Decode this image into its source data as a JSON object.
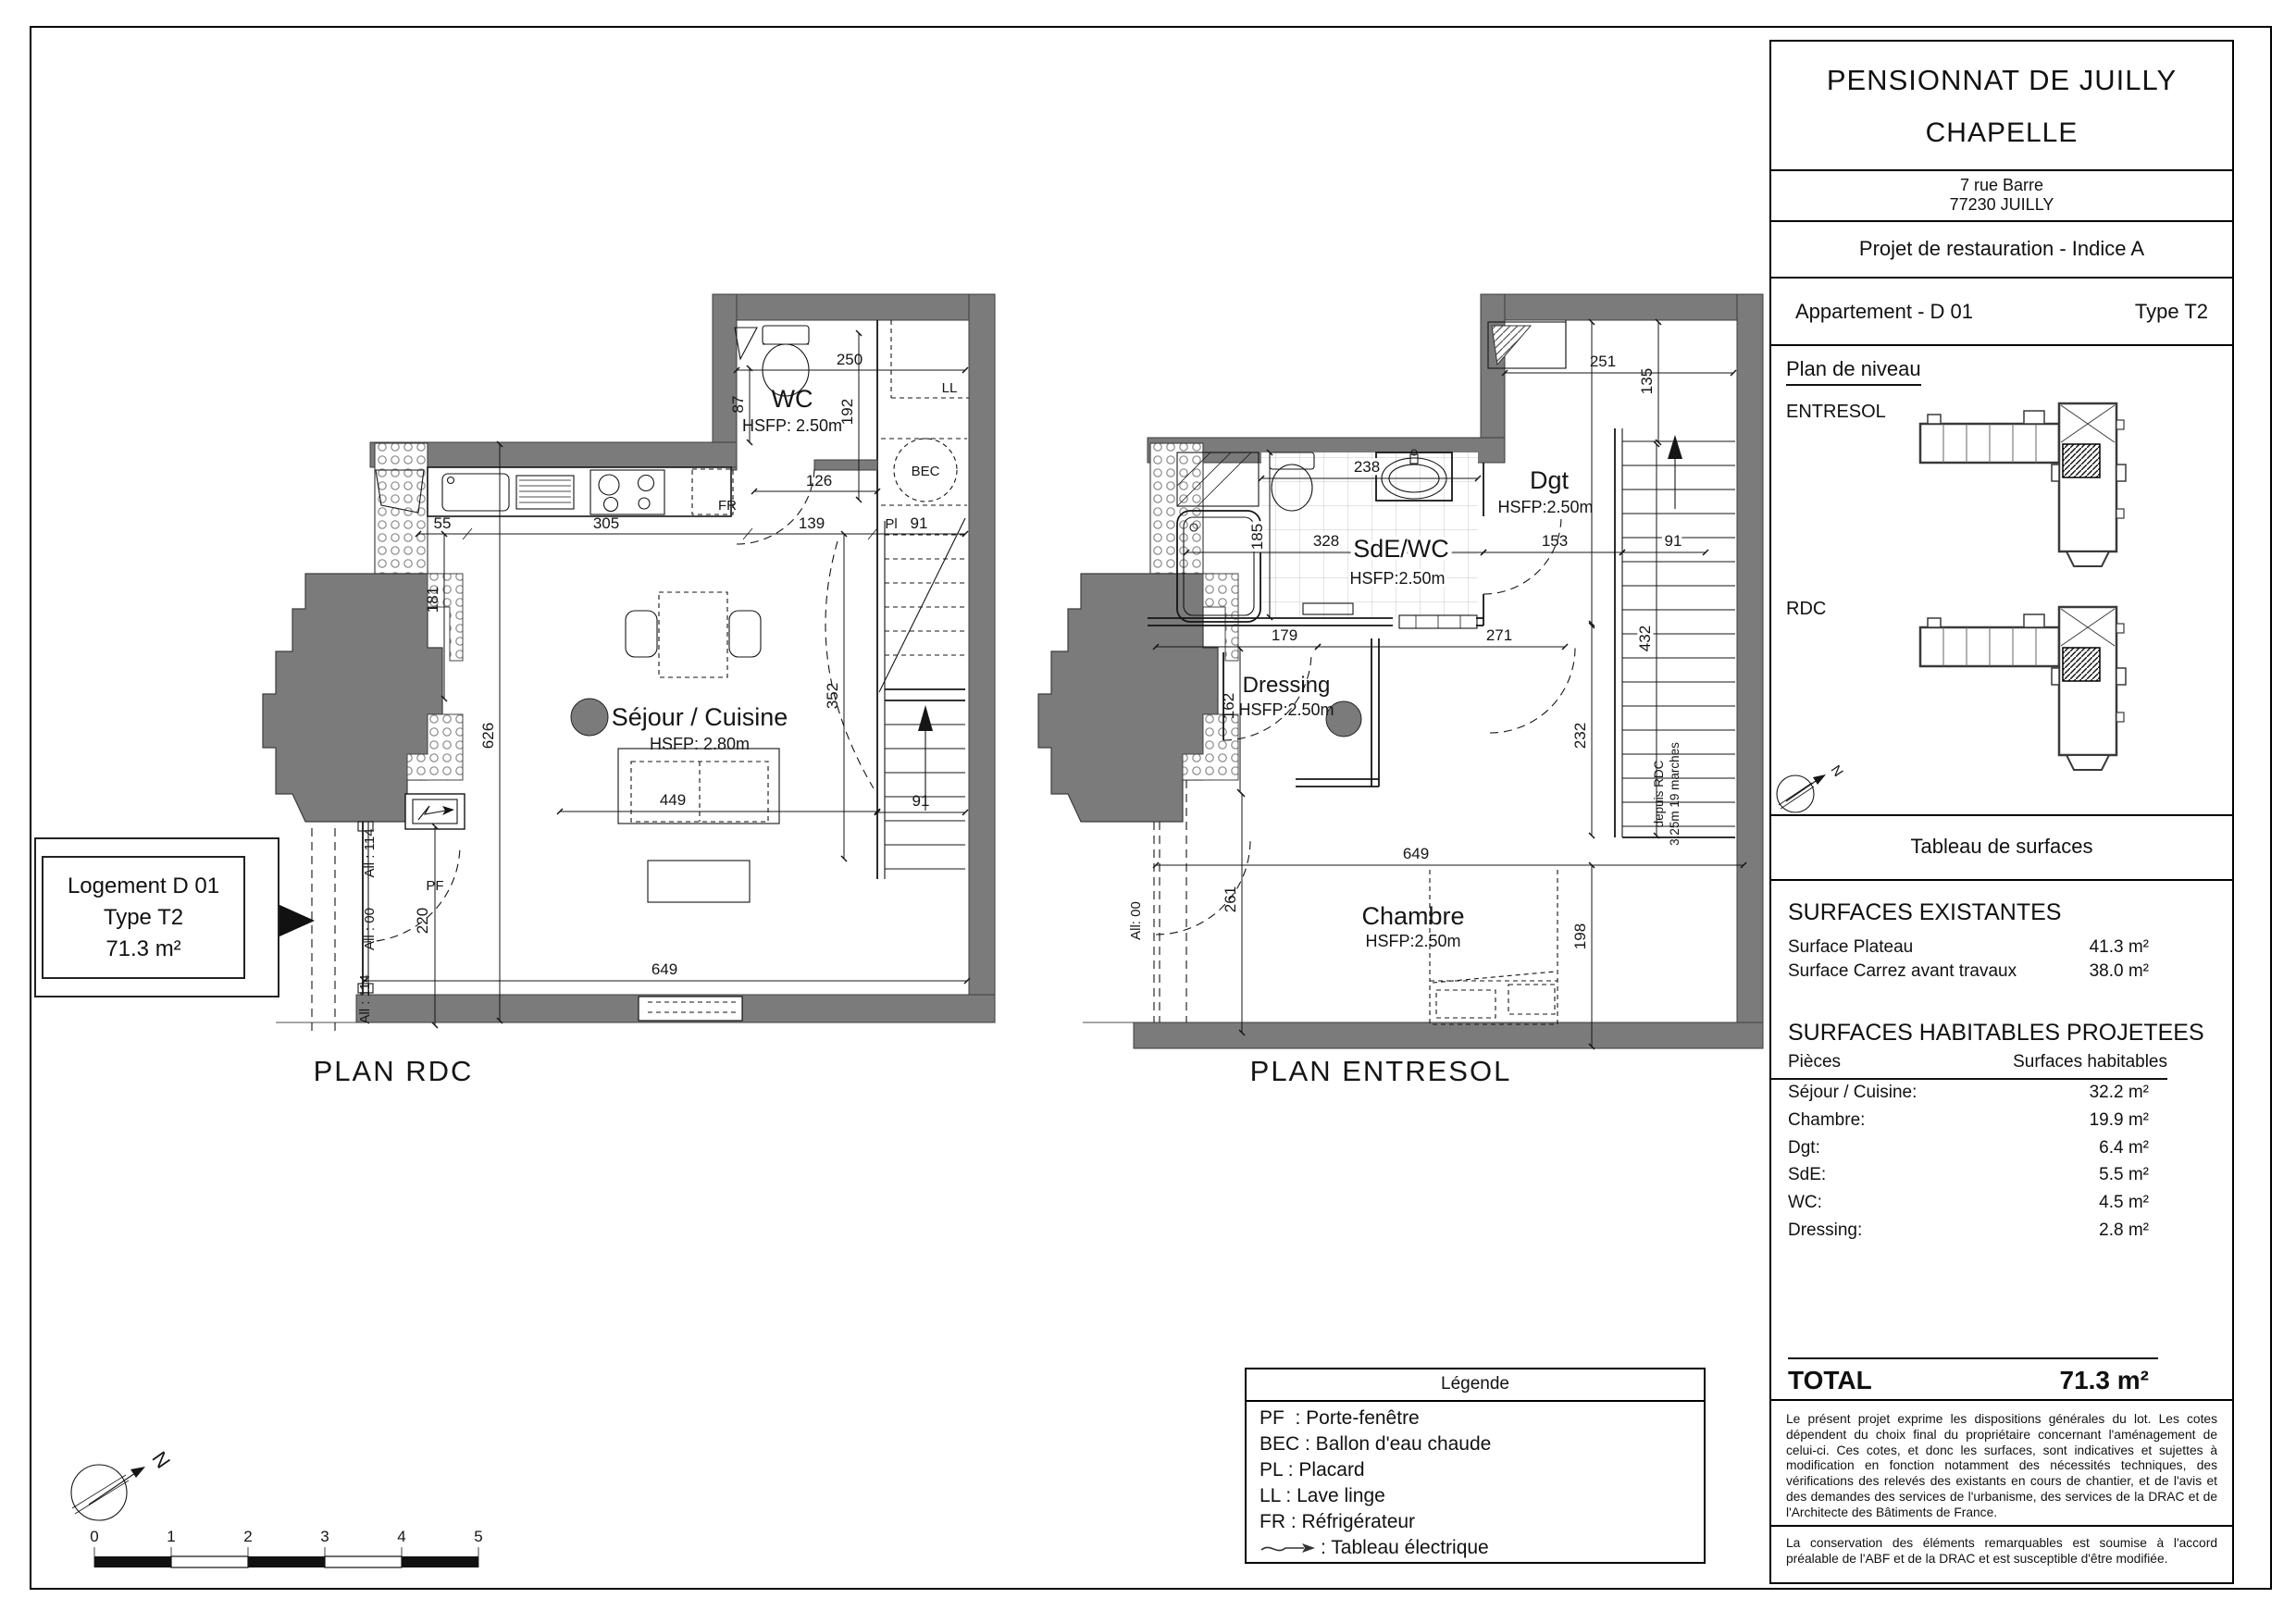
{
  "colors": {
    "wall_gray": "#7b7b7b",
    "line": "#151515"
  },
  "title_block": {
    "title1": "PENSIONNAT DE JUILLY",
    "title2": "CHAPELLE",
    "address1": "7 rue Barre",
    "address2": "77230 JUILLY",
    "project": "Projet de restauration - Indice A",
    "apartment": "Appartement - D 01",
    "apartment_type": "Type T2",
    "level_plan_title": "Plan de niveau",
    "level_entresol": "ENTRESOL",
    "level_rdc": "RDC",
    "surfaces_title": "Tableau de surfaces",
    "existing_title": "SURFACES EXISTANTES",
    "existing": [
      {
        "label": "Surface Plateau",
        "value": "41.3 m²"
      },
      {
        "label": "Surface Carrez avant travaux",
        "value": "38.0 m²"
      }
    ],
    "projected_title": "SURFACES HABITABLES PROJETEES",
    "col_rooms": "Pièces",
    "col_surfaces": "Surfaces habitables",
    "projected": [
      {
        "label": "Séjour / Cuisine:",
        "value": "32.2 m²"
      },
      {
        "label": "Chambre:",
        "value": "19.9 m²"
      },
      {
        "label": "Dgt:",
        "value": "6.4 m²"
      },
      {
        "label": "SdE:",
        "value": "5.5 m²"
      },
      {
        "label": "WC:",
        "value": "4.5 m²"
      },
      {
        "label": "Dressing:",
        "value": "2.8 m²"
      }
    ],
    "total_label": "TOTAL",
    "total_value": "71.3 m²",
    "disclaimer1": "Le présent projet exprime les dispositions générales du lot. Les cotes dépendent du choix final du propriétaire concernant l'aménagement de celui-ci. Ces cotes, et donc les surfaces, sont indicatives et sujettes à modification en fonction notamment des nécessités techniques, des vérifications des relevés des existants en cours de chantier, et de l'avis et des demandes des services de l'urbanisme, des services de la DRAC et de l'Architecte des Bâtiments de France.",
    "disclaimer2": "La conservation des éléments remarquables est soumise à l'accord préalable de l'ABF et de la DRAC et est susceptible d'être modifiée."
  },
  "legend": {
    "title": "Légende",
    "items": "PF  : Porte-fenêtre\nBEC : Ballon d'eau chaude\nPL : Placard\nLL : Lave linge\nFR : Réfrigérateur",
    "electrical": ": Tableau électrique"
  },
  "logement_box": {
    "line1": "Logement D 01",
    "line2": "Type T2",
    "line3": "71.3 m²"
  },
  "compass": {
    "letter": "N"
  },
  "scale_bar": {
    "labels": [
      "0",
      "1",
      "2",
      "3",
      "4",
      "5"
    ]
  },
  "plans": {
    "rdc": {
      "title": "PLAN RDC",
      "rooms": {
        "wc": "WC",
        "wc_h": "HSFP: 2.50m",
        "sejour": "Séjour / Cuisine",
        "sejour_h": "HSFP: 2.80m"
      },
      "labels": {
        "ll": "LL",
        "bec": "BEC",
        "fr": "FR",
        "pf": "PF",
        "pl": "Pl",
        "all114a": "All : 114",
        "all00": "All : 00",
        "all114b": "All : 114"
      },
      "dims": {
        "d250": "250",
        "d87": "87",
        "d192": "192",
        "d126": "126",
        "d55": "55",
        "d305": "305",
        "d139": "139",
        "d91a": "91",
        "d181": "181",
        "d626": "626",
        "d352": "352",
        "d91b": "91",
        "d449": "449",
        "d220": "220",
        "d649": "649"
      }
    },
    "entresol": {
      "title": "PLAN ENTRESOL",
      "rooms": {
        "dgt": "Dgt",
        "dgt_h": "HSFP:2.50m",
        "sde": "SdE/WC",
        "sde_h": "HSFP:2.50m",
        "dressing": "Dressing",
        "dressing_h": "HSFP:2.50m",
        "chambre": "Chambre",
        "chambre_h": "HSFP:2.50m"
      },
      "labels": {
        "all00": "All: 00",
        "stair1": "depuis RDC",
        "stair2": "3.25m 19 marches"
      },
      "dims": {
        "d251": "251",
        "d135": "135",
        "d238": "238",
        "d185": "185",
        "d328": "328",
        "d153": "153",
        "d91": "91",
        "d432": "432",
        "d232": "232",
        "d179": "179",
        "d271": "271",
        "d162": "162",
        "d261": "261",
        "d649": "649",
        "d198": "198"
      }
    }
  }
}
